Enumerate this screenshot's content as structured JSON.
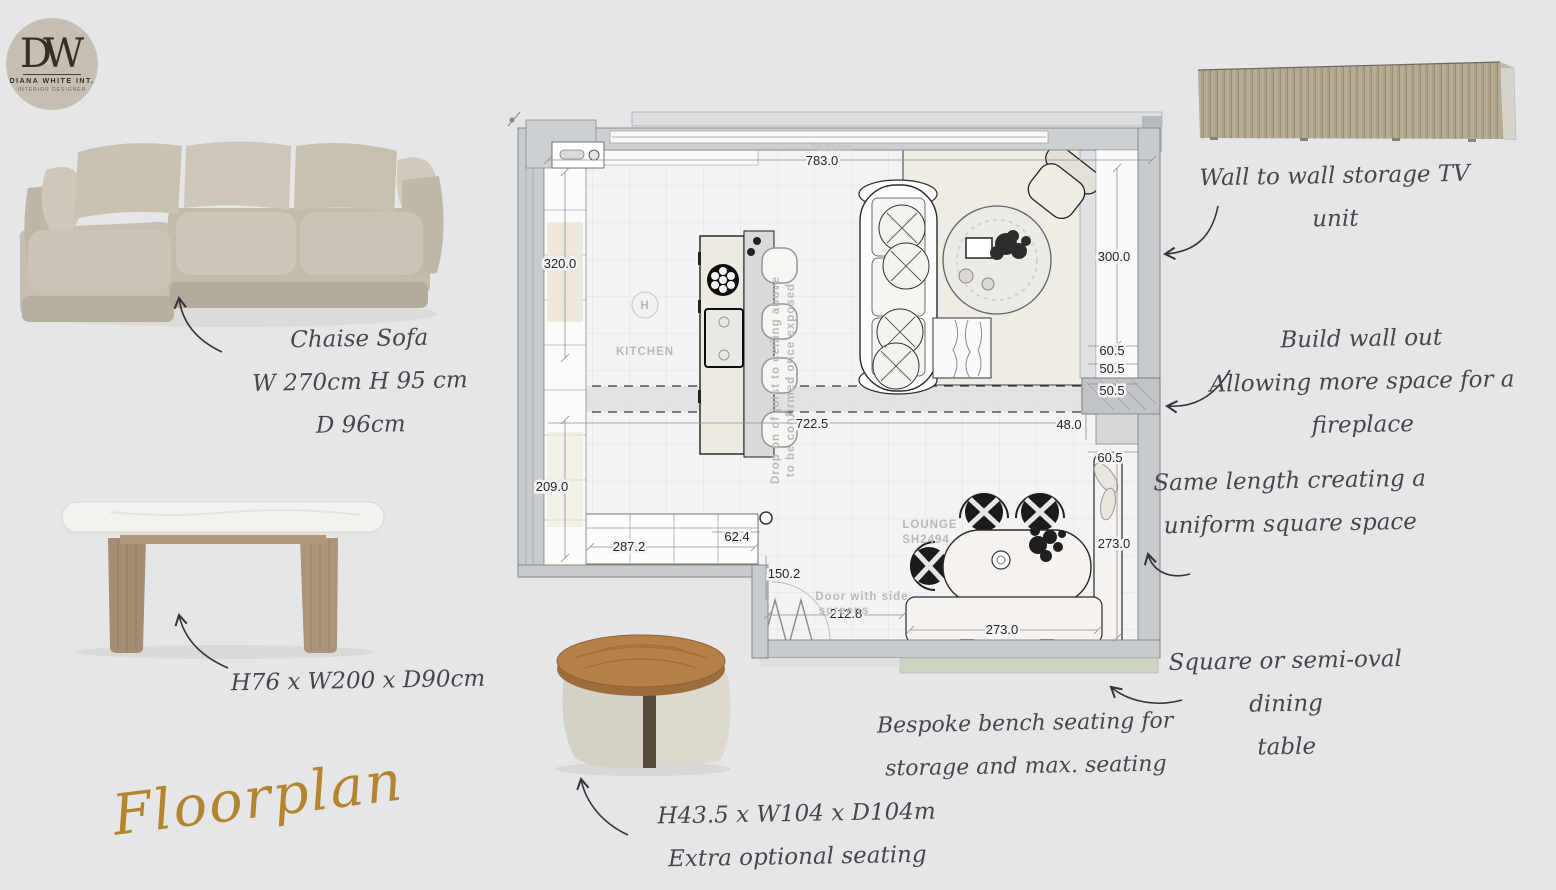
{
  "page_title": "Floorplan",
  "logo": {
    "monogram": "DW",
    "name": "DIANA WHITE INT.",
    "subtitle": "INTERIOR DESIGNER"
  },
  "products": {
    "sofa": {
      "title": "Chaise Sofa",
      "dims1": "W 270cm H 95 cm",
      "dims2": "D 96cm"
    },
    "dining_table": {
      "dims": "H76 x W200 x D90cm"
    },
    "coffee_table": {
      "dims": "H43.5 x W104 x D104m",
      "note": "Extra optional seating"
    }
  },
  "annotations": {
    "tv": {
      "l1": "Wall to wall storage TV",
      "l2": "unit"
    },
    "wall": {
      "l1": "Build wall out",
      "l2": "Allowing more space for a",
      "l3": "fireplace"
    },
    "square": {
      "l1": "Same length creating a",
      "l2": "uniform square space"
    },
    "dining": {
      "l1": "Square or semi-oval dining",
      "l2": "table"
    },
    "bench": {
      "l1": "Bespoke bench seating for",
      "l2": "storage and max. seating"
    }
  },
  "floorplan": {
    "labels": {
      "kitchen": "KITCHEN",
      "lounge": "LOUNGE",
      "lounge_code": "SH2494",
      "door1": "Door with side",
      "door2": "screens",
      "joist1": "Drop on of joist to ceiling above",
      "joist2": "to be confirmed once exposed",
      "hmark": "H",
      "faint_top": "7830mm"
    },
    "dims": {
      "top": "783.0",
      "left_upper": "320.0",
      "left_lower": "209.0",
      "right_upper": "300.0",
      "niche1": "60.5",
      "niche2": "50.5",
      "niche3": "50.5",
      "beam": "722.5",
      "recess": "48.0",
      "niche4": "60.5",
      "right_lower": "273.0",
      "bench": "273.0",
      "counter": "287.2",
      "counter_gap": "62.4",
      "door_side": "150.2",
      "door_width": "212.8"
    }
  },
  "colors": {
    "accent_gold": "#b5842f",
    "ink": "#46474b",
    "wall_gray": "#c8cbce"
  }
}
